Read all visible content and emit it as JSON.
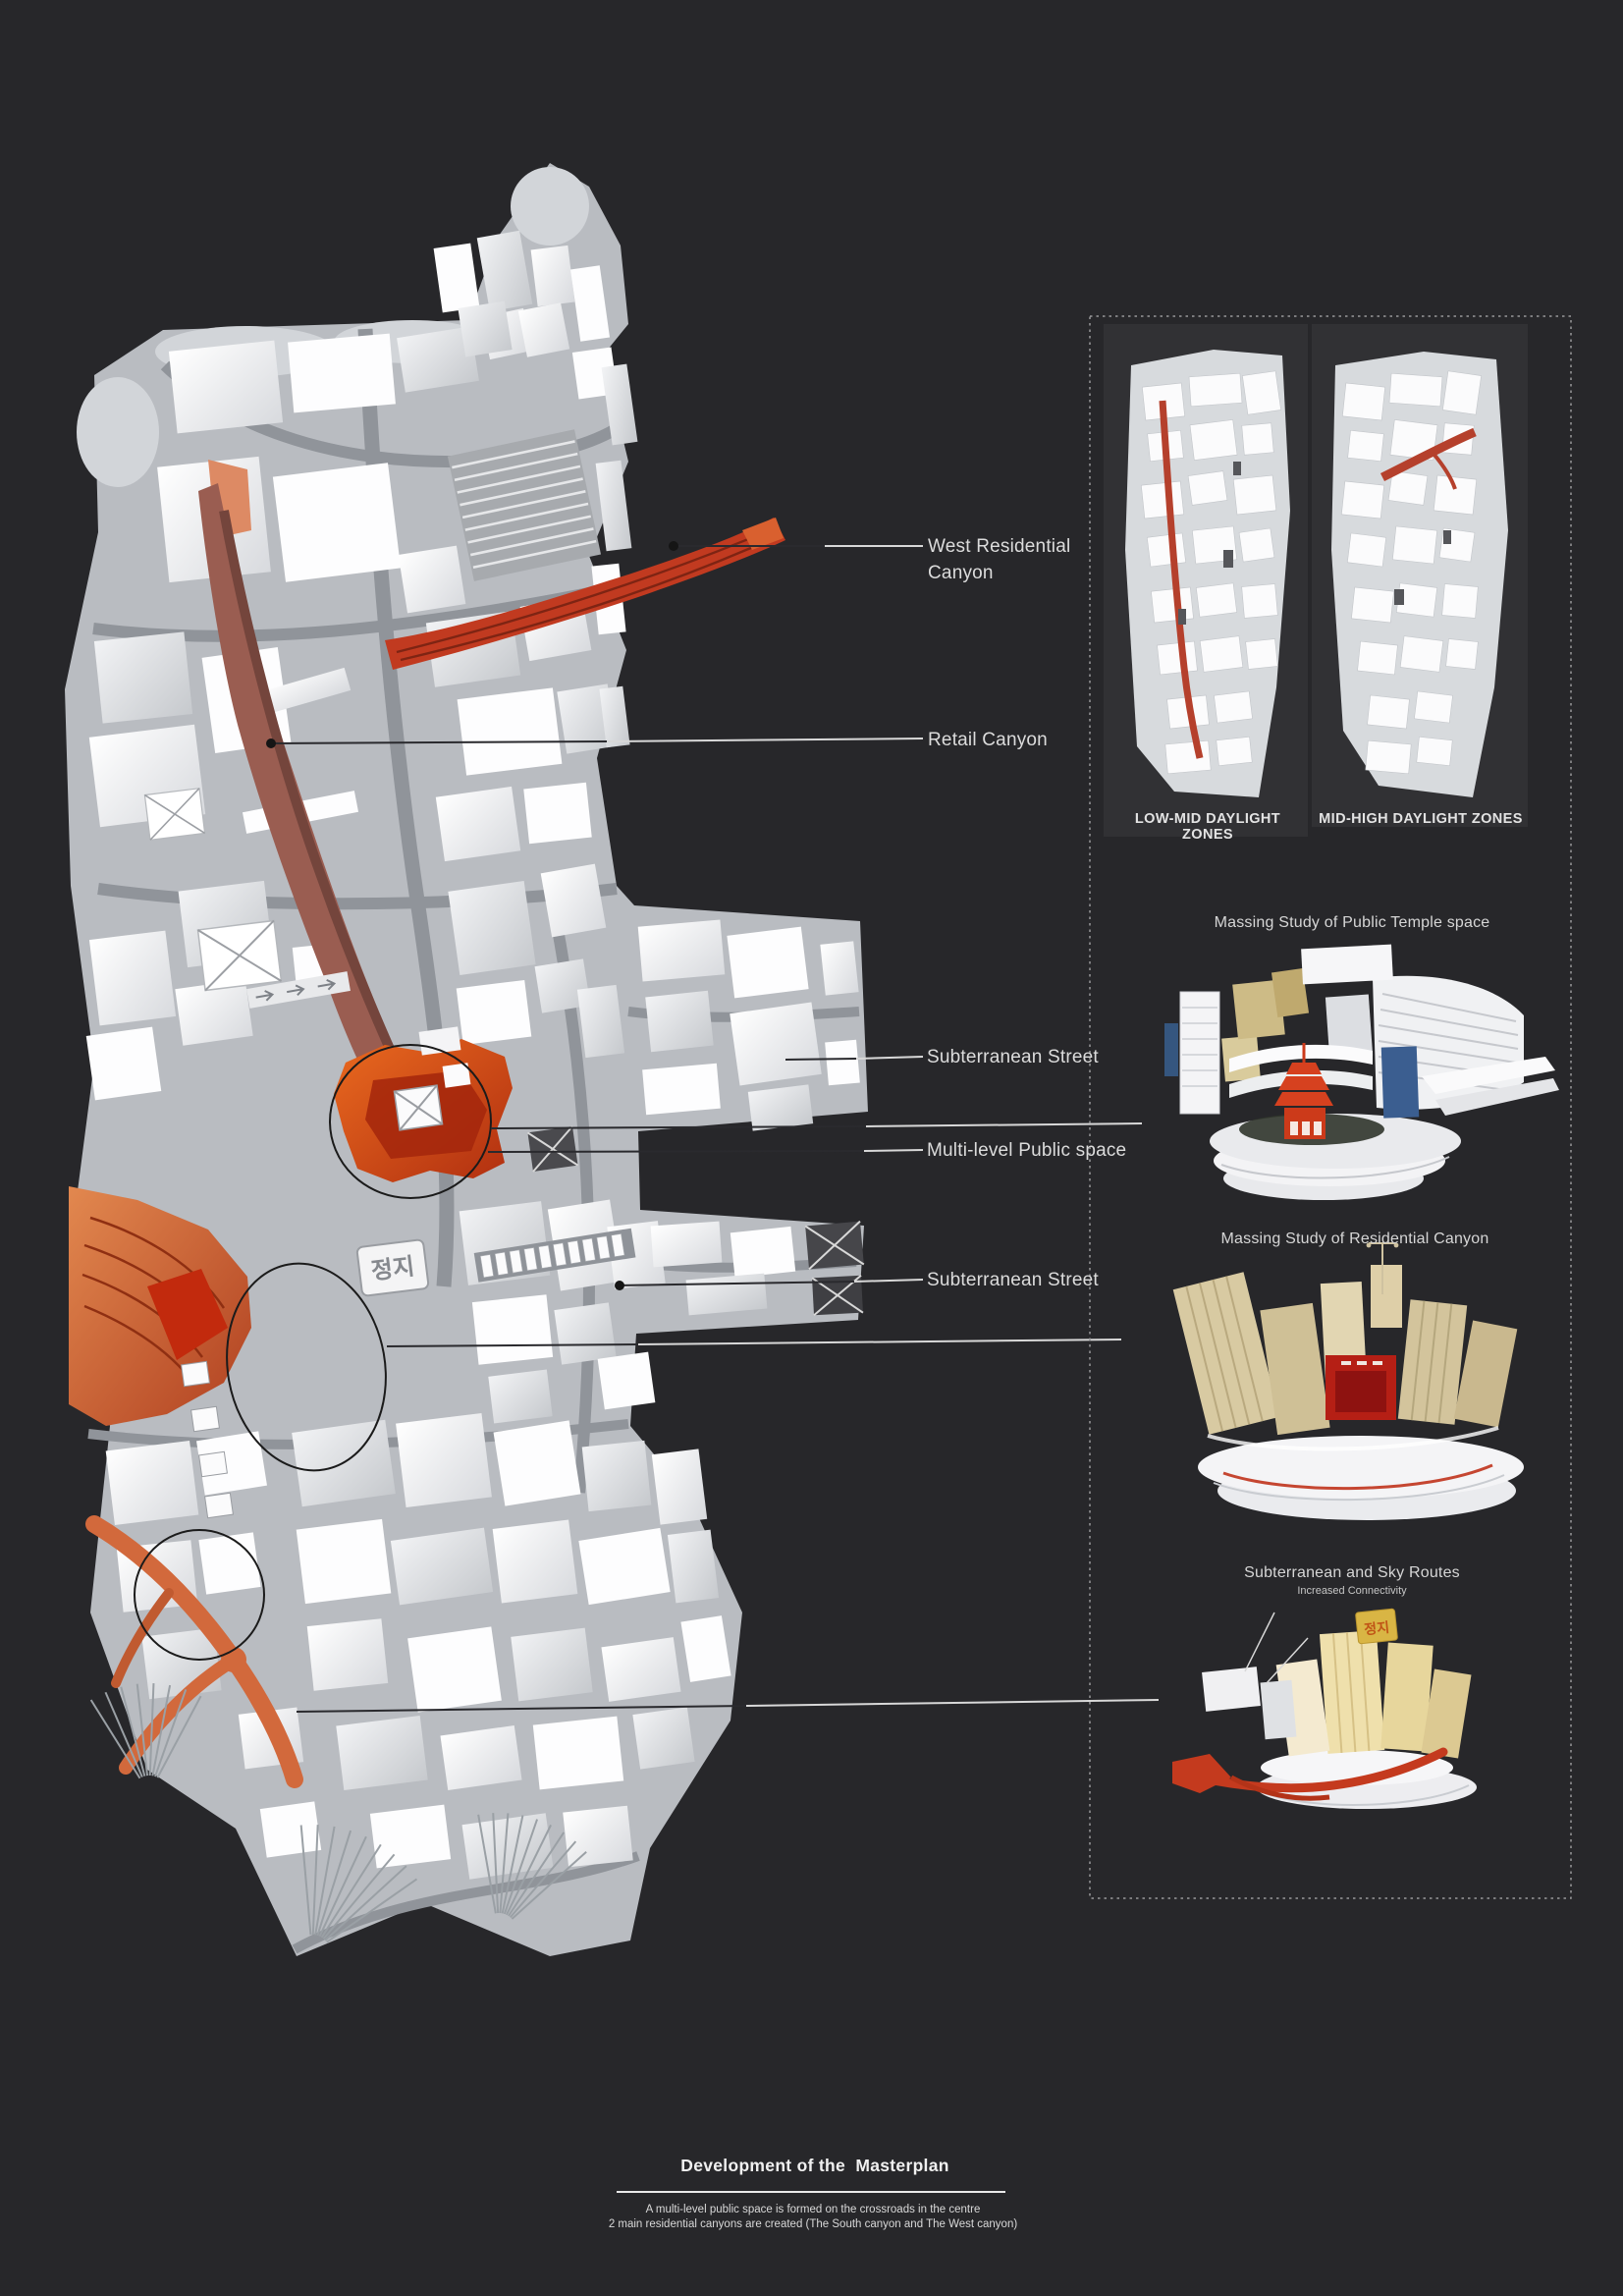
{
  "palette": {
    "background": "#27272a",
    "model_white": "#f4f5f7",
    "street_gray": "#b9bcc1",
    "canyon_red": "#c13a20",
    "canyon_maroon": "#9a5d51",
    "plaza_orange": "#e0500f",
    "south_canyon_orange": "#df8553",
    "route_ribbon_orange": "#d2693c",
    "label_text": "#dcdcdc"
  },
  "main_model": {
    "labels": [
      {
        "text": "West Residential Canyon"
      },
      {
        "text": "Retail Canyon"
      },
      {
        "text": "Subterranean Street"
      },
      {
        "text": "Multi-level Public space"
      },
      {
        "text": "Subterranean Street"
      }
    ],
    "signs": {
      "stop": "정지"
    }
  },
  "side_panel": {
    "daylight": {
      "left_caption": "LOW-MID DAYLIGHT ZONES",
      "right_caption": "MID-HIGH DAYLIGHT ZONES"
    },
    "studies": [
      {
        "title": "Massing Study of Public Temple space"
      },
      {
        "title": "Massing Study of Residential Canyon"
      },
      {
        "title": "Subterranean and Sky Routes",
        "subtitle": "Increased Connectivity"
      }
    ]
  },
  "footer": {
    "title": "Development of the  Masterplan",
    "line1": "A multi-level public space is formed on the crossroads in the centre",
    "line2": "2 main residential canyons are created (The South canyon and The West canyon)"
  }
}
